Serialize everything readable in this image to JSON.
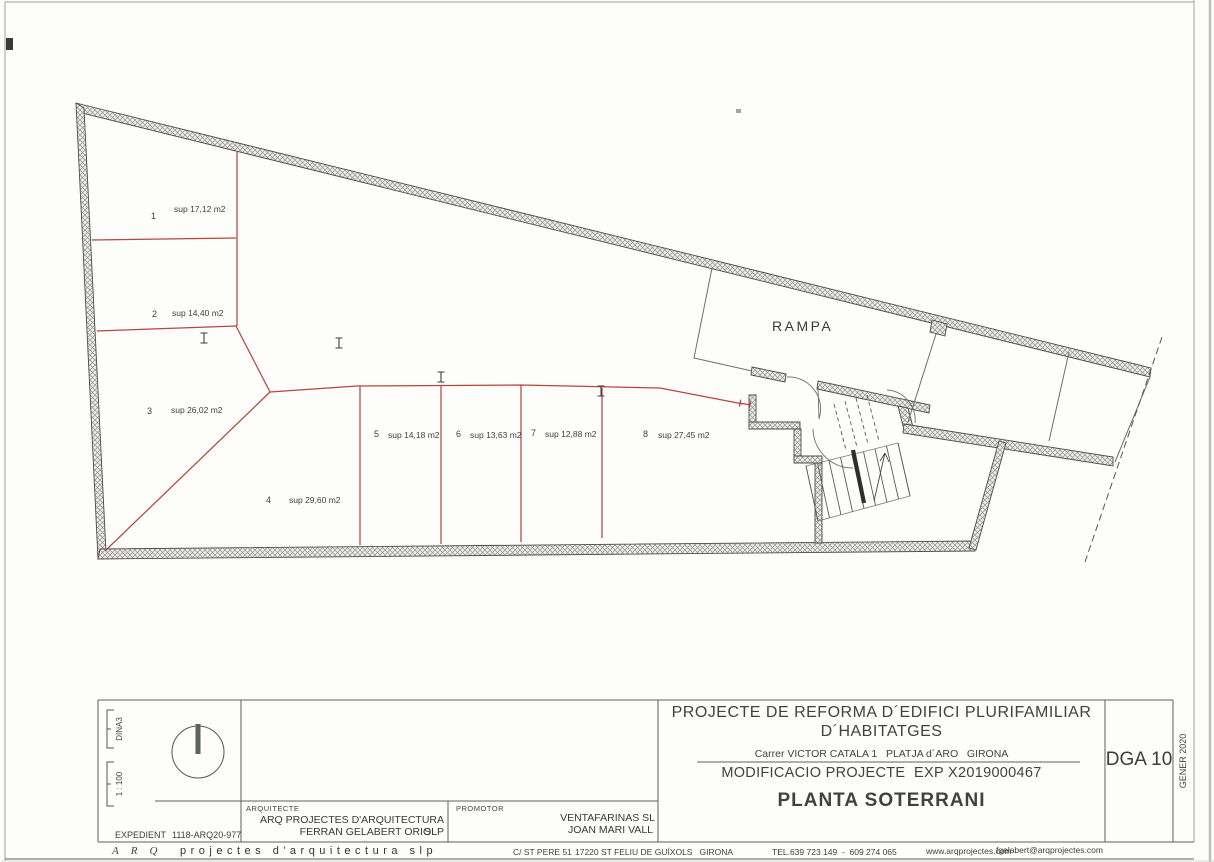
{
  "plan": {
    "rampa_label": "RAMPA",
    "spaces": [
      {
        "num": "1",
        "label": "sup 17,12 m2"
      },
      {
        "num": "2",
        "label": "sup 14,40 m2"
      },
      {
        "num": "3",
        "label": "sup 26,02 m2"
      },
      {
        "num": "4",
        "label": "sup 29,60 m2"
      },
      {
        "num": "5",
        "label": "sup 14,18 m2"
      },
      {
        "num": "6",
        "label": "sup 13,63 m2"
      },
      {
        "num": "7",
        "label": "sup 12,88 m2"
      },
      {
        "num": "8",
        "label": "sup 27,45 m2"
      }
    ]
  },
  "title_block": {
    "project_line1": "PROJECTE DE REFORMA D´EDIFICI PLURIFAMILIAR",
    "project_line2": "D´HABITATGES",
    "address": "Carrer VICTOR CATALA 1   PLATJA d´ARO   GIRONA",
    "modification": "MODIFICACIO PROJECTE  EXP X2019000467",
    "sheet_title": "PLANTA SOTERRANI",
    "sheet_code": "DGA 10",
    "date": "GENER 2020",
    "paper_size": "DINA3",
    "scale": "1 : 100",
    "expedient_label": "EXPEDIENT",
    "expedient_value": "1118-ARQ20-977",
    "architect_label": "ARQUITECTE",
    "architect_line1": "ARQ PROJECTES D'ARQUITECTURA SLP",
    "architect_line2": "FERRAN GELABERT ORIOL",
    "developer_label": "PROMOTOR",
    "developer_line1": "VENTAFARINAS SL",
    "developer_line2": "JOAN MARI VALL"
  },
  "footer": {
    "brand_initials": "ARQ",
    "brand_name": "projectes d'arquitectura slp",
    "street": "C/ ST PERE 51",
    "city": "17220 ST FELIU DE GUÍXOLS   GIRONA",
    "phone": "TEL.639 723 149  -  609 274 065",
    "website": "www.arqprojectes.com",
    "email": "fgelabert@arqprojectes.com"
  },
  "colors": {
    "red_line": "#b5473c",
    "wall_stroke": "#4c4c4c",
    "line_gray": "#5e5e5e"
  }
}
